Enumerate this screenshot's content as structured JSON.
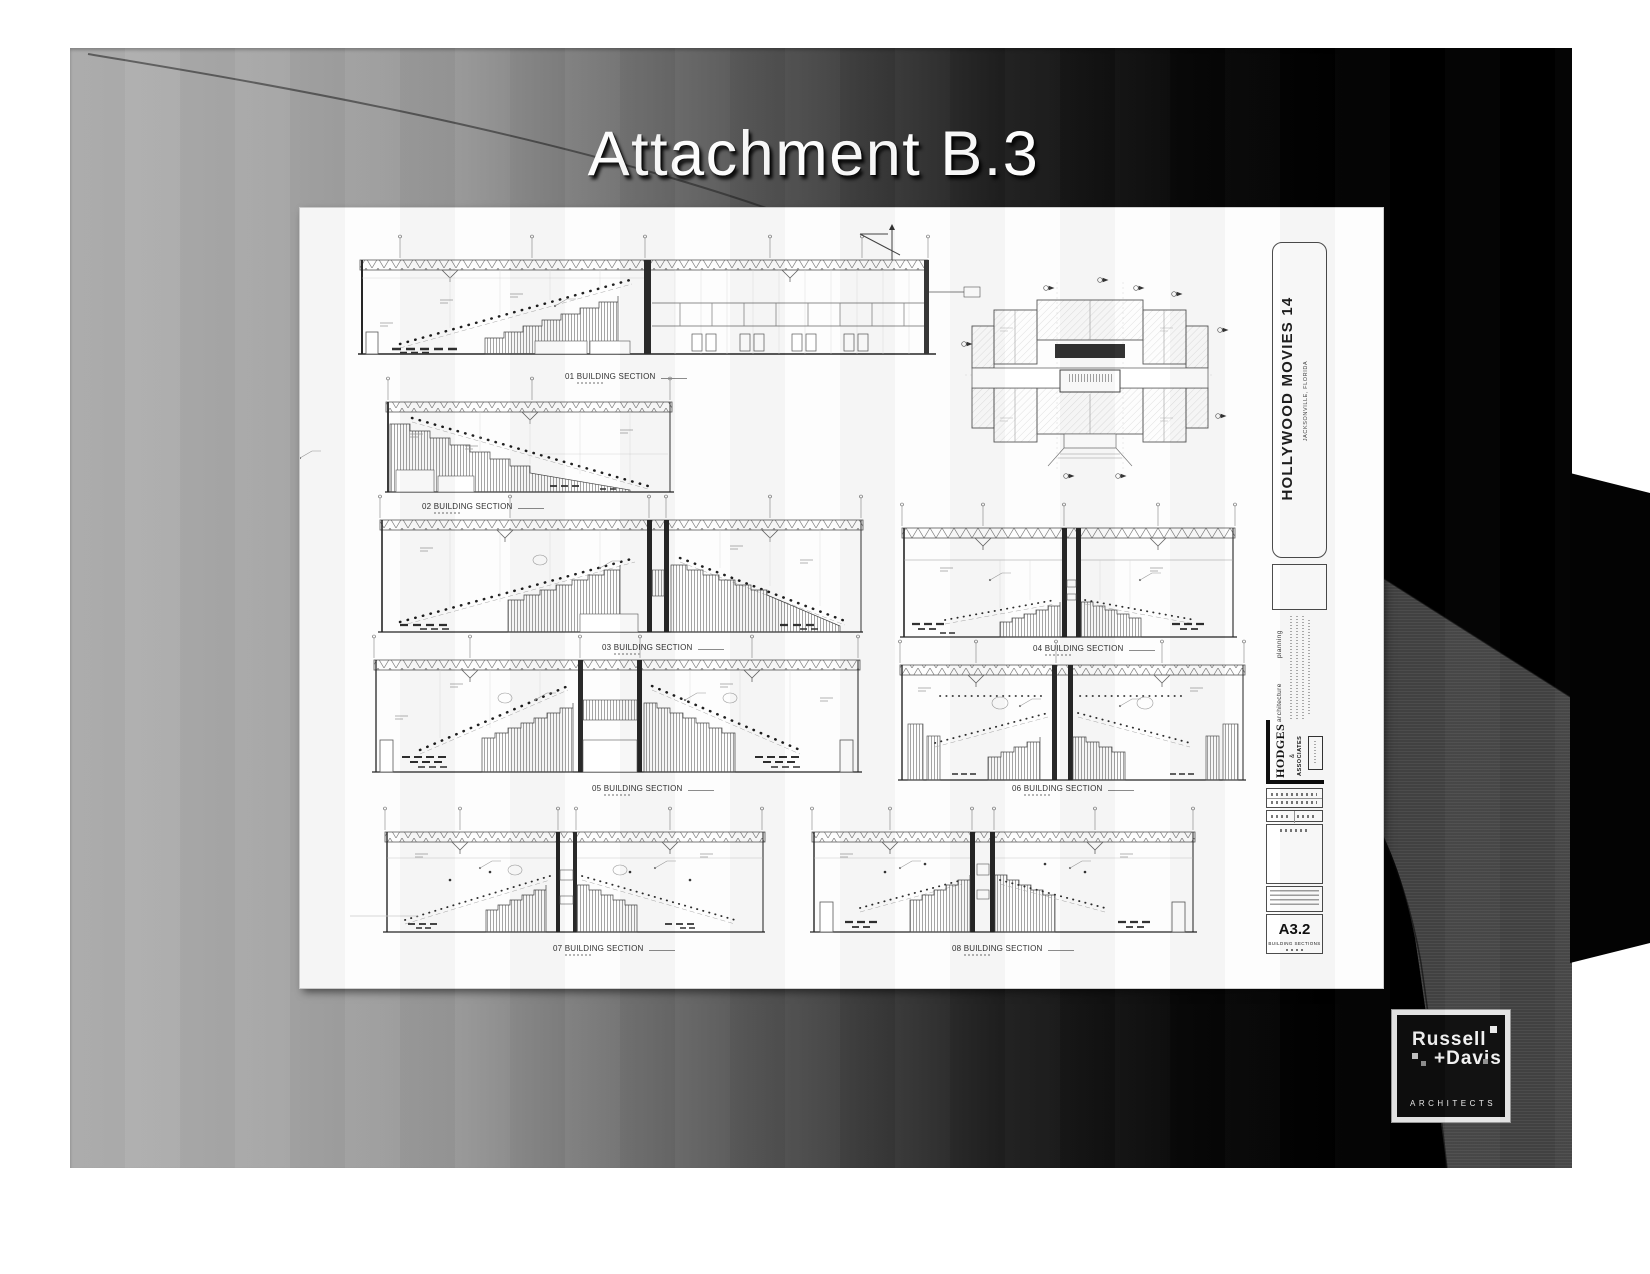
{
  "slide": {
    "title": "Attachment B.3"
  },
  "colors": {
    "slide_bg_left": "#b2b2b2",
    "slide_bg_right": "#000000",
    "swoosh_band": "#434343",
    "title_text": "#fdfdfd",
    "logo_frame": "#e8e8e8",
    "logo_bg": "#0d0d0d"
  },
  "sheet": {
    "sections": [
      {
        "num": "01",
        "label": "01 BUILDING SECTION"
      },
      {
        "num": "02",
        "label": "02 BUILDING SECTION"
      },
      {
        "num": "03",
        "label": "03 BUILDING SECTION"
      },
      {
        "num": "04",
        "label": "04 BUILDING SECTION"
      },
      {
        "num": "05",
        "label": "05 BUILDING SECTION"
      },
      {
        "num": "06",
        "label": "06 BUILDING SECTION"
      },
      {
        "num": "07",
        "label": "07 BUILDING SECTION"
      },
      {
        "num": "08",
        "label": "08 BUILDING SECTION"
      }
    ],
    "titleblock": {
      "project": "HOLLYWOOD MOVIES 14",
      "location": "JACKSONVILLE, FLORIDA",
      "practice1": "architecture",
      "practice2": "planning",
      "firm": "HODGES",
      "firm_amp": "&",
      "firm_assoc": "ASSOCIATES",
      "sheet_number": "A3.2",
      "sheet_title": "BUILDING SECTIONS"
    }
  },
  "logo": {
    "line1": "Russell",
    "line2": "+Davis",
    "line3": "ARCHITECTS"
  }
}
